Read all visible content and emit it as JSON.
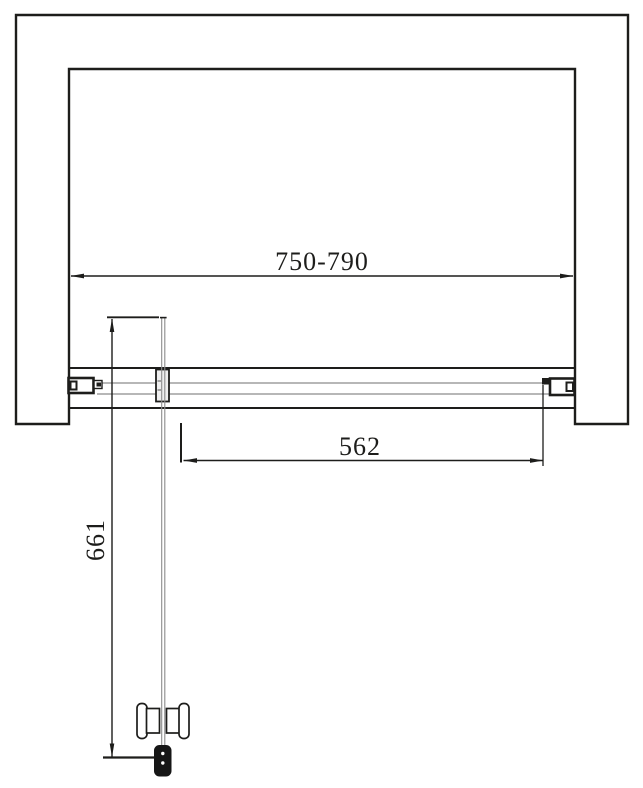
{
  "drawing": {
    "type": "technical-plan-view",
    "subject": "shower-door-enclosure",
    "dimensions": {
      "overall_width": "750-790",
      "door_opening_width": "562",
      "door_panel_length": "661"
    },
    "colors": {
      "line": "#1d1d1b",
      "glass_line": "#8c8c8c",
      "pivot_fill": "#efefef",
      "stopper_fill": "#161616",
      "background": "#ffffff"
    }
  }
}
